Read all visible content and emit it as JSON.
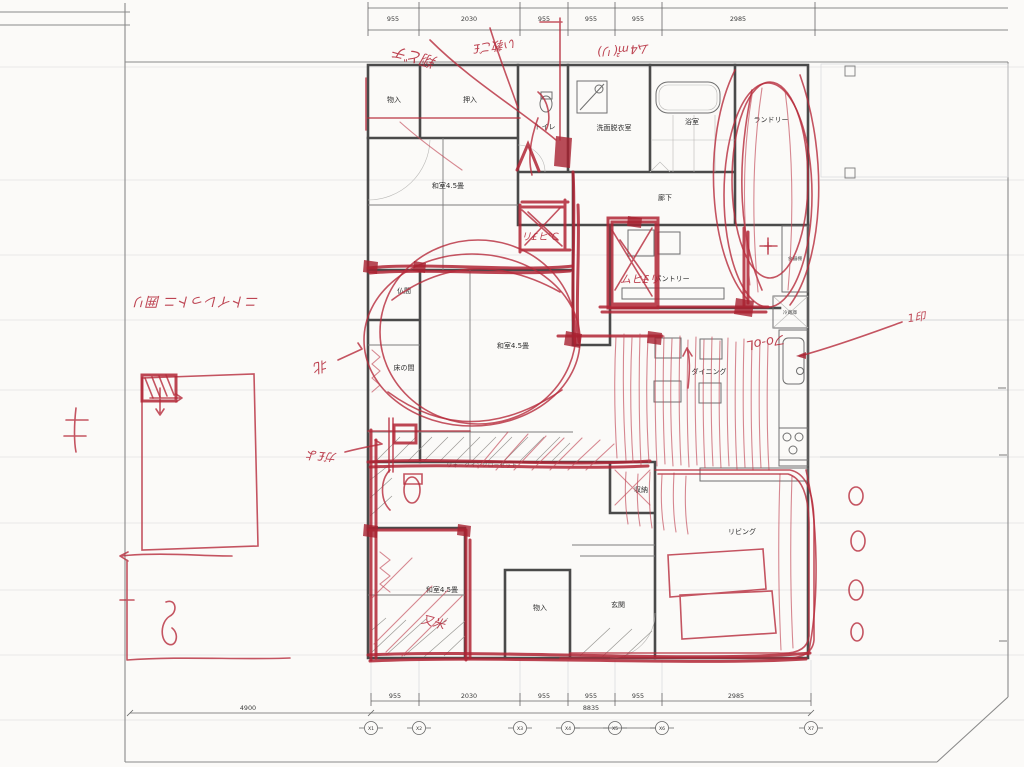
{
  "colors": {
    "red_pen": "#b02535",
    "plan_line": "#4a4a4a",
    "paper": "#fbfaf8"
  },
  "dim_top": [
    "955",
    "2030",
    "955",
    "955",
    "955",
    "2985"
  ],
  "dim_bottom": [
    "955",
    "2030",
    "955",
    "955",
    "955",
    "2985"
  ],
  "dim_total_bottom": "8835",
  "dim_left_bottom": "4900",
  "axes": [
    "X1",
    "X2",
    "X3",
    "X4",
    "X5",
    "X6",
    "X7"
  ],
  "rooms": {
    "monoire_top": "物入",
    "oshiire": "押入",
    "toilet": "トイレ",
    "senmen": "洗面脱衣室",
    "bath": "浴室",
    "laundry": "ランドリー",
    "washitsu_top": "和室4.5畳",
    "rouka": "廊下",
    "butsuma": "仏間",
    "tokonoma": "床の間",
    "washitsu_center": "和室4.5畳",
    "pantry": "パントリー",
    "dining": "ダイニング",
    "shokkidana": "食器棚",
    "reizouko": "冷蔵庫",
    "shuno": "収納",
    "living": "リビング",
    "washitsu_bottom": "和室4.5畳",
    "monoire_bottom": "物入",
    "genkan": "玄関",
    "wic": "ウォークインクローゼット"
  },
  "red_notes": {
    "n1": "翔どチ",
    "n2": "い教ご£",
    "n3": "ム4㎡(リ)",
    "n4": "ニトイレっトニ 囲リ",
    "n5": "リ£ヒ℃",
    "n6": "ムヒ£リ",
    "n7": "フo-oL",
    "n8": "+",
    "n9": "北",
    "n10": "ガ£よ",
    "n11": "1印",
    "n12": "又米"
  }
}
